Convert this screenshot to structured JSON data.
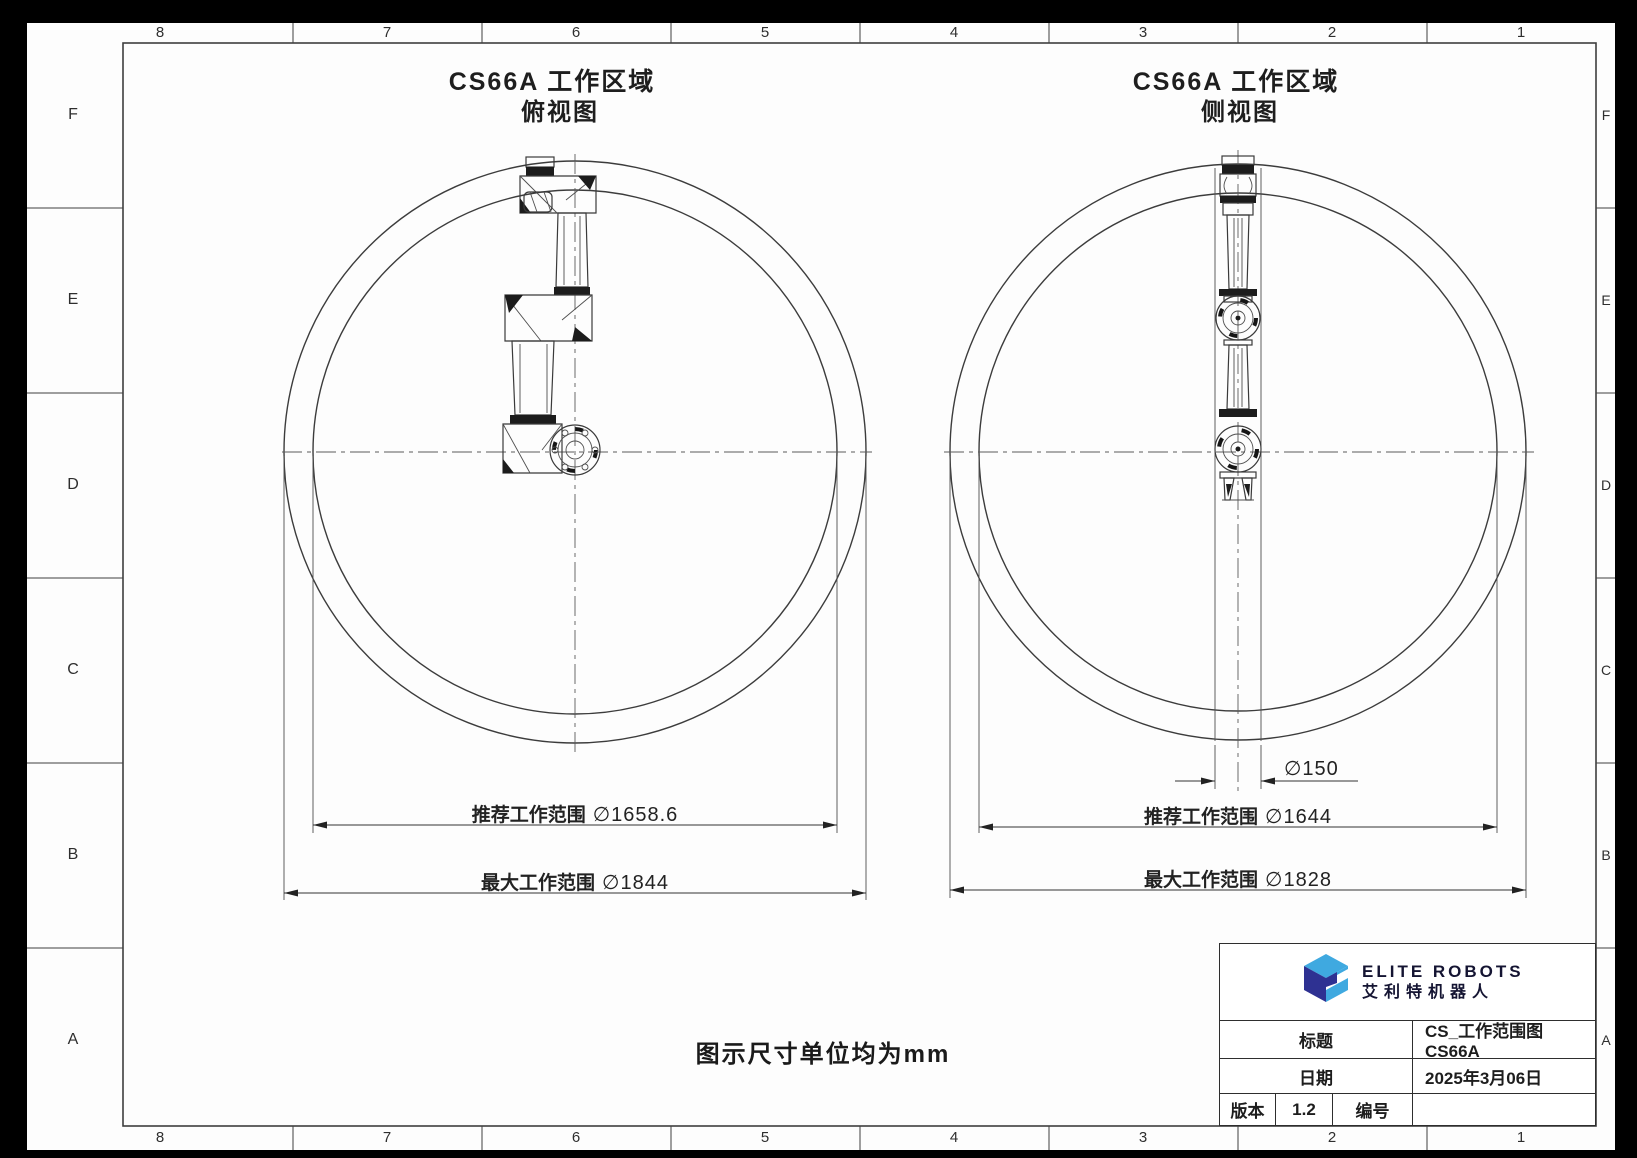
{
  "frame": {
    "top_labels": [
      "8",
      "7",
      "6",
      "5",
      "4",
      "3",
      "2",
      "1"
    ],
    "bottom_labels": [
      "8",
      "7",
      "6",
      "5",
      "4",
      "3",
      "2",
      "1"
    ],
    "left_labels": [
      "F",
      "E",
      "D",
      "C",
      "B",
      "A"
    ],
    "right_labels": [
      "F",
      "E",
      "D",
      "C",
      "B",
      "A"
    ]
  },
  "top_view": {
    "title": "CS66A 工作区域",
    "subtitle": "俯视图",
    "recommended_label": "推荐工作范围",
    "recommended_value": "∅1658.6",
    "max_label": "最大工作范围",
    "max_value": "∅1844"
  },
  "side_view": {
    "title": "CS66A 工作区域",
    "subtitle": "侧视图",
    "column_diameter": "∅150",
    "recommended_label": "推荐工作范围",
    "recommended_value": "∅1644",
    "max_label": "最大工作范围",
    "max_value": "∅1828"
  },
  "note": "图示尺寸单位均为mm",
  "title_block": {
    "brand_en": "ELITE ROBOTS",
    "brand_cn": "艾利特机器人",
    "title_label": "标题",
    "title_value": "CS_工作范围图 CS66A",
    "date_label": "日期",
    "date_value": "2025年3月06日",
    "version_label": "版本",
    "version_value": "1.2",
    "number_label": "编号",
    "number_value": ""
  },
  "colors": {
    "logo_light": "#3FA9E0",
    "logo_dark": "#2E3192",
    "line": "#3a3a3a"
  }
}
